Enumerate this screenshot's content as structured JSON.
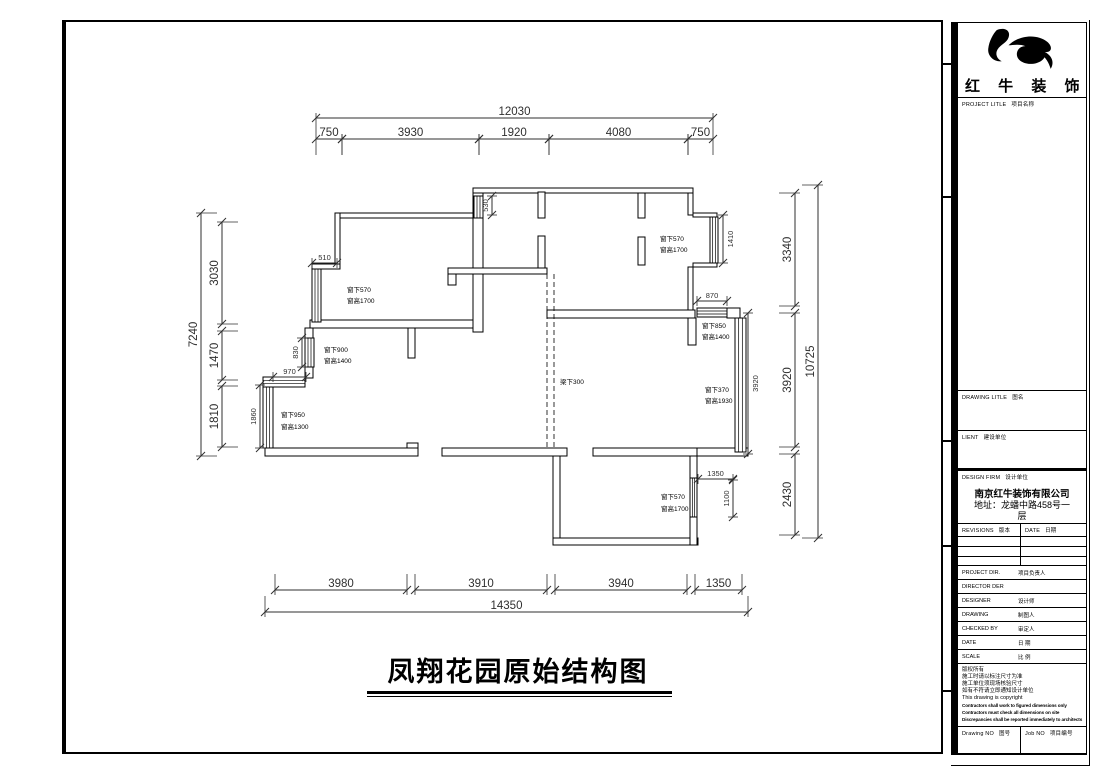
{
  "main": {
    "title": "凤翔花园原始结构图"
  },
  "title_block": {
    "logo_text": "红 牛 装 饰",
    "logo_icon": "bull-swoosh",
    "sections": {
      "project_title": {
        "en": "PROJECT LITLE",
        "cn": "项目名称"
      },
      "drawing_title": {
        "en": "DRAWING LITLE",
        "cn": "图名"
      },
      "client": {
        "en": "LIENT",
        "cn": "建设单位"
      },
      "design_firm": {
        "en": "DESIGN FIRM",
        "cn": "设计单位"
      },
      "company_name": "南京红牛装饰有限公司",
      "company_addr1": "地址：龙蟠中路458号一",
      "company_addr2": "层",
      "revisions": {
        "en": "REVISIONS",
        "cn": "版本"
      },
      "date_col": {
        "en": "DATE",
        "cn": "日期"
      },
      "rows": [
        {
          "en": "PROJECT DIR.",
          "cn": "项目负责人"
        },
        {
          "en": "DIRECTOR DER",
          "cn": ""
        },
        {
          "en": "DESIGNER",
          "cn": "设计师"
        },
        {
          "en": "DRAWING",
          "cn": "制图人"
        },
        {
          "en": "CHECKED BY",
          "cn": "审定人"
        },
        {
          "en": "DATE",
          "cn": "日 期"
        },
        {
          "en": "SCALE",
          "cn": "比 例"
        }
      ],
      "notes": [
        "版权所有",
        "施工时请以标注尺寸为准",
        "施工单位须现场核验尺寸",
        "如有不符请立即通知设计单位",
        "This drawing is copyright"
      ],
      "notes_bold": [
        "Contractors shall work to figured dimensions only",
        "Contractors must check all dimensions on site",
        "Discrepancies shall be reported immediately to architects"
      ],
      "drawing_no": {
        "en": "Drawing NO",
        "cn": "图号"
      },
      "job_no": {
        "en": "Job NO",
        "cn": "项目编号"
      }
    }
  },
  "plan": {
    "dim_color": "#2f2f2f",
    "hdims": [
      {
        "x1": 316,
        "x2": 713,
        "y": 118,
        "t": "12030"
      },
      {
        "x1": 316,
        "x2": 342,
        "y": 139,
        "t": "750"
      },
      {
        "x1": 342,
        "x2": 479,
        "y": 139,
        "t": "3930"
      },
      {
        "x1": 479,
        "x2": 549,
        "y": 139,
        "t": "1920"
      },
      {
        "x1": 549,
        "x2": 688,
        "y": 139,
        "t": "4080"
      },
      {
        "x1": 688,
        "x2": 713,
        "y": 139,
        "t": "750"
      },
      {
        "x1": 275,
        "x2": 407,
        "y": 590,
        "t": "3980"
      },
      {
        "x1": 415,
        "x2": 547,
        "y": 590,
        "t": "3910"
      },
      {
        "x1": 555,
        "x2": 687,
        "y": 590,
        "t": "3940"
      },
      {
        "x1": 695,
        "x2": 742,
        "y": 590,
        "t": "1350"
      },
      {
        "x1": 265,
        "x2": 748,
        "y": 612,
        "t": "14350"
      },
      {
        "x1": 312,
        "x2": 337,
        "y": 263,
        "t": "510",
        "small": true
      },
      {
        "x1": 273,
        "x2": 306,
        "y": 377,
        "t": "970",
        "small": true
      },
      {
        "x1": 697,
        "x2": 727,
        "y": 301,
        "t": "870",
        "small": true
      },
      {
        "x1": 698,
        "x2": 733,
        "y": 479,
        "t": "1350",
        "small": true
      }
    ],
    "vdims": [
      {
        "y1": 213,
        "y2": 456,
        "x": 201,
        "t": "7240"
      },
      {
        "y1": 222,
        "y2": 324,
        "x": 222,
        "t": "3030"
      },
      {
        "y1": 331,
        "y2": 380,
        "x": 222,
        "t": "1470"
      },
      {
        "y1": 386,
        "y2": 447,
        "x": 222,
        "t": "1810"
      },
      {
        "y1": 185,
        "y2": 538,
        "x": 818,
        "t": "10725"
      },
      {
        "y1": 193,
        "y2": 306,
        "x": 795,
        "t": "3340"
      },
      {
        "y1": 313,
        "y2": 447,
        "x": 795,
        "t": "3920"
      },
      {
        "y1": 454,
        "y2": 535,
        "x": 795,
        "t": "2430"
      },
      {
        "y1": 196,
        "y2": 215,
        "x": 492,
        "t": "530",
        "small": true
      },
      {
        "y1": 338,
        "y2": 367,
        "x": 302,
        "t": "830",
        "small": true
      },
      {
        "y1": 385,
        "y2": 448,
        "x": 260,
        "t": "1860",
        "small": true
      },
      {
        "y1": 215,
        "y2": 263,
        "x": 723,
        "t": "1410",
        "small": true,
        "side": "right"
      },
      {
        "y1": 313,
        "y2": 454,
        "x": 748,
        "t": "3920",
        "small": true,
        "side": "right"
      },
      {
        "y1": 480,
        "y2": 517,
        "x": 733,
        "t": "1100",
        "small": true
      }
    ],
    "walls": [
      [
        335,
        213,
        148,
        5
      ],
      [
        335,
        213,
        5,
        53
      ],
      [
        312,
        264,
        28,
        5
      ],
      [
        310,
        320,
        173,
        8
      ],
      [
        408,
        328,
        7,
        30
      ],
      [
        473,
        188,
        220,
        5
      ],
      [
        473,
        193,
        10,
        139
      ],
      [
        538,
        192,
        7,
        26
      ],
      [
        538,
        236,
        7,
        32
      ],
      [
        638,
        193,
        7,
        25
      ],
      [
        638,
        237,
        7,
        28
      ],
      [
        448,
        268,
        99,
        6
      ],
      [
        448,
        274,
        8,
        11
      ],
      [
        688,
        193,
        5,
        22
      ],
      [
        693,
        213,
        24,
        4
      ],
      [
        693,
        263,
        24,
        4
      ],
      [
        688,
        267,
        5,
        45
      ],
      [
        547,
        310,
        148,
        8
      ],
      [
        688,
        318,
        8,
        27
      ],
      [
        727,
        308,
        13,
        10
      ],
      [
        697,
        448,
        51,
        8
      ],
      [
        553,
        456,
        7,
        84
      ],
      [
        553,
        538,
        145,
        7
      ],
      [
        690,
        448,
        7,
        30
      ],
      [
        690,
        517,
        7,
        28
      ],
      [
        593,
        448,
        104,
        8
      ],
      [
        265,
        448,
        153,
        8
      ],
      [
        407,
        443,
        11,
        5
      ],
      [
        442,
        448,
        125,
        8
      ],
      [
        305,
        328,
        8,
        50
      ]
    ],
    "windows": [
      {
        "o": "v",
        "x": 312,
        "y": 269,
        "w": 9,
        "h": 53
      },
      {
        "o": "v",
        "x": 305,
        "y": 338,
        "w": 9,
        "h": 29
      },
      {
        "o": "v",
        "x": 263,
        "y": 385,
        "w": 10,
        "h": 63
      },
      {
        "o": "v",
        "x": 474,
        "y": 196,
        "w": 9,
        "h": 22
      },
      {
        "o": "v",
        "x": 710,
        "y": 217,
        "w": 8,
        "h": 46
      },
      {
        "o": "v",
        "x": 735,
        "y": 318,
        "w": 11,
        "h": 134
      },
      {
        "o": "v",
        "x": 690,
        "y": 478,
        "w": 7,
        "h": 39
      },
      {
        "o": "h",
        "x": 697,
        "y": 308,
        "w": 30,
        "h": 9
      },
      {
        "o": "h",
        "x": 263,
        "y": 377,
        "w": 42,
        "h": 10
      }
    ],
    "beams": [
      [
        547,
        274,
        547,
        448
      ],
      [
        554,
        274,
        554,
        448
      ]
    ],
    "labels": [
      {
        "x": 347,
        "y": 292,
        "t": "窗下570"
      },
      {
        "x": 347,
        "y": 303,
        "t": "窗高1700"
      },
      {
        "x": 324,
        "y": 352,
        "t": "窗下900"
      },
      {
        "x": 324,
        "y": 363,
        "t": "窗高1400"
      },
      {
        "x": 281,
        "y": 417,
        "t": "窗下950"
      },
      {
        "x": 281,
        "y": 429,
        "t": "窗高1300"
      },
      {
        "x": 660,
        "y": 241,
        "t": "窗下570"
      },
      {
        "x": 660,
        "y": 252,
        "t": "窗高1700"
      },
      {
        "x": 702,
        "y": 328,
        "t": "窗下850"
      },
      {
        "x": 702,
        "y": 339,
        "t": "窗高1400"
      },
      {
        "x": 705,
        "y": 392,
        "t": "窗下370"
      },
      {
        "x": 705,
        "y": 403,
        "t": "窗高1930"
      },
      {
        "x": 661,
        "y": 499,
        "t": "窗下570"
      },
      {
        "x": 661,
        "y": 511,
        "t": "窗高1700"
      },
      {
        "x": 560,
        "y": 384,
        "t": "梁下300"
      }
    ]
  }
}
